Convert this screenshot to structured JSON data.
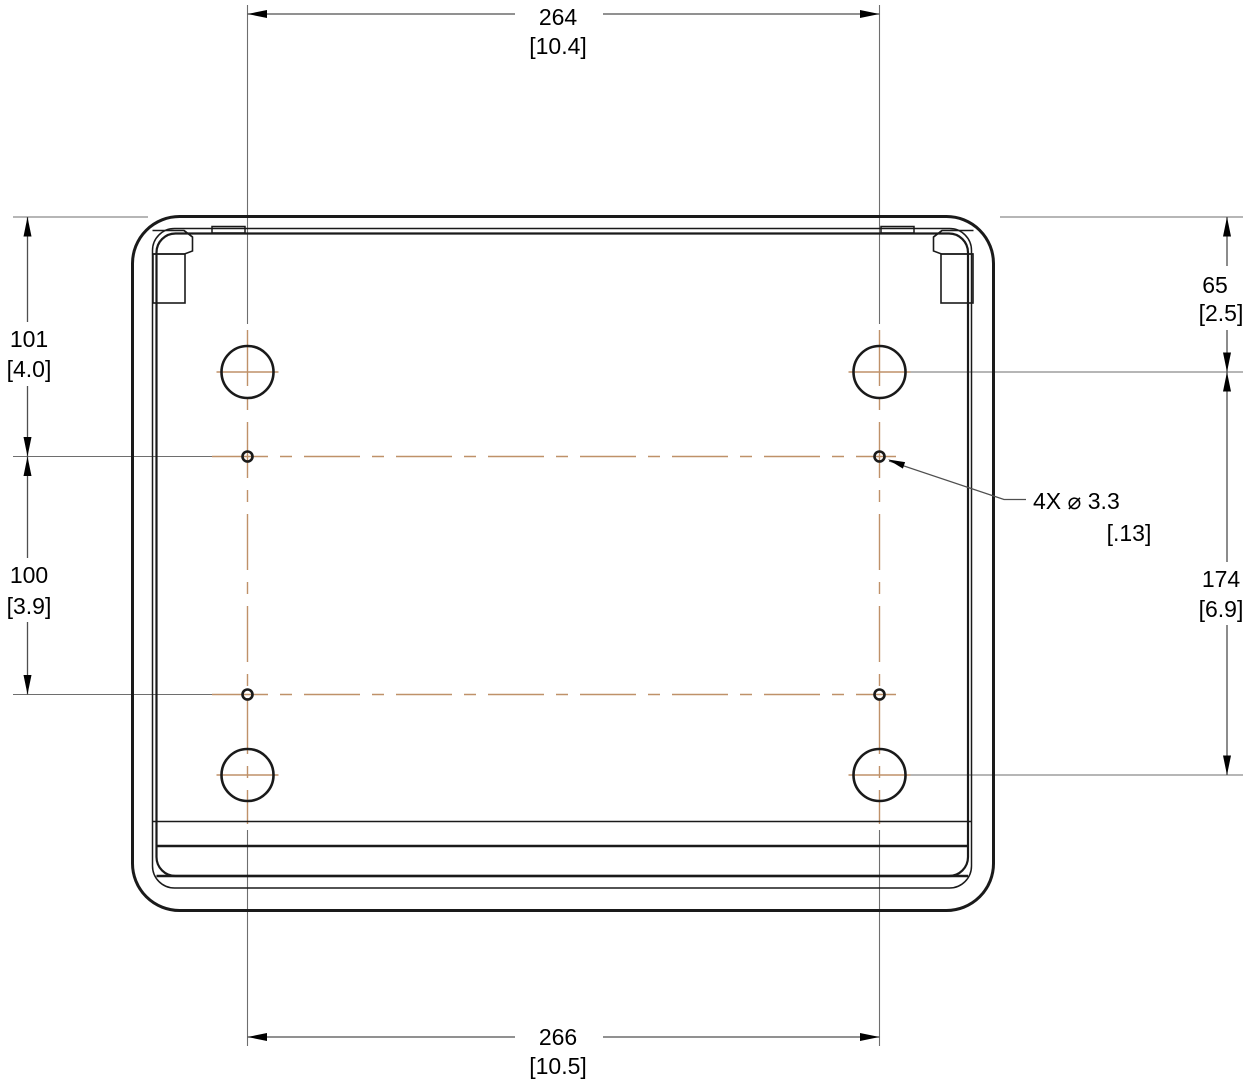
{
  "drawing": {
    "type": "technical-dimension-drawing",
    "view": "enclosure bottom view with mounting hole layout",
    "dims": {
      "top": {
        "mm": "264",
        "in": "[10.4]"
      },
      "bottom": {
        "mm": "266",
        "in": "[10.5]"
      },
      "left_upper": {
        "mm": "101",
        "in": "[4.0]"
      },
      "left_lower": {
        "mm": "100",
        "in": "[3.9]"
      },
      "right_upper": {
        "mm": "65",
        "in": "[2.5]"
      },
      "right_lower": {
        "mm": "174",
        "in": "[6.9]"
      },
      "hole_callout": {
        "label": "4X ⌀ 3.3",
        "in": "[.13]"
      }
    },
    "colors": {
      "object_line": "#1a1a1a",
      "dimension_line": "#4f4f4f",
      "extension_line": "#6e6e6e",
      "centerline": "#bf9169",
      "text": "#000000",
      "background": "#ffffff"
    }
  }
}
